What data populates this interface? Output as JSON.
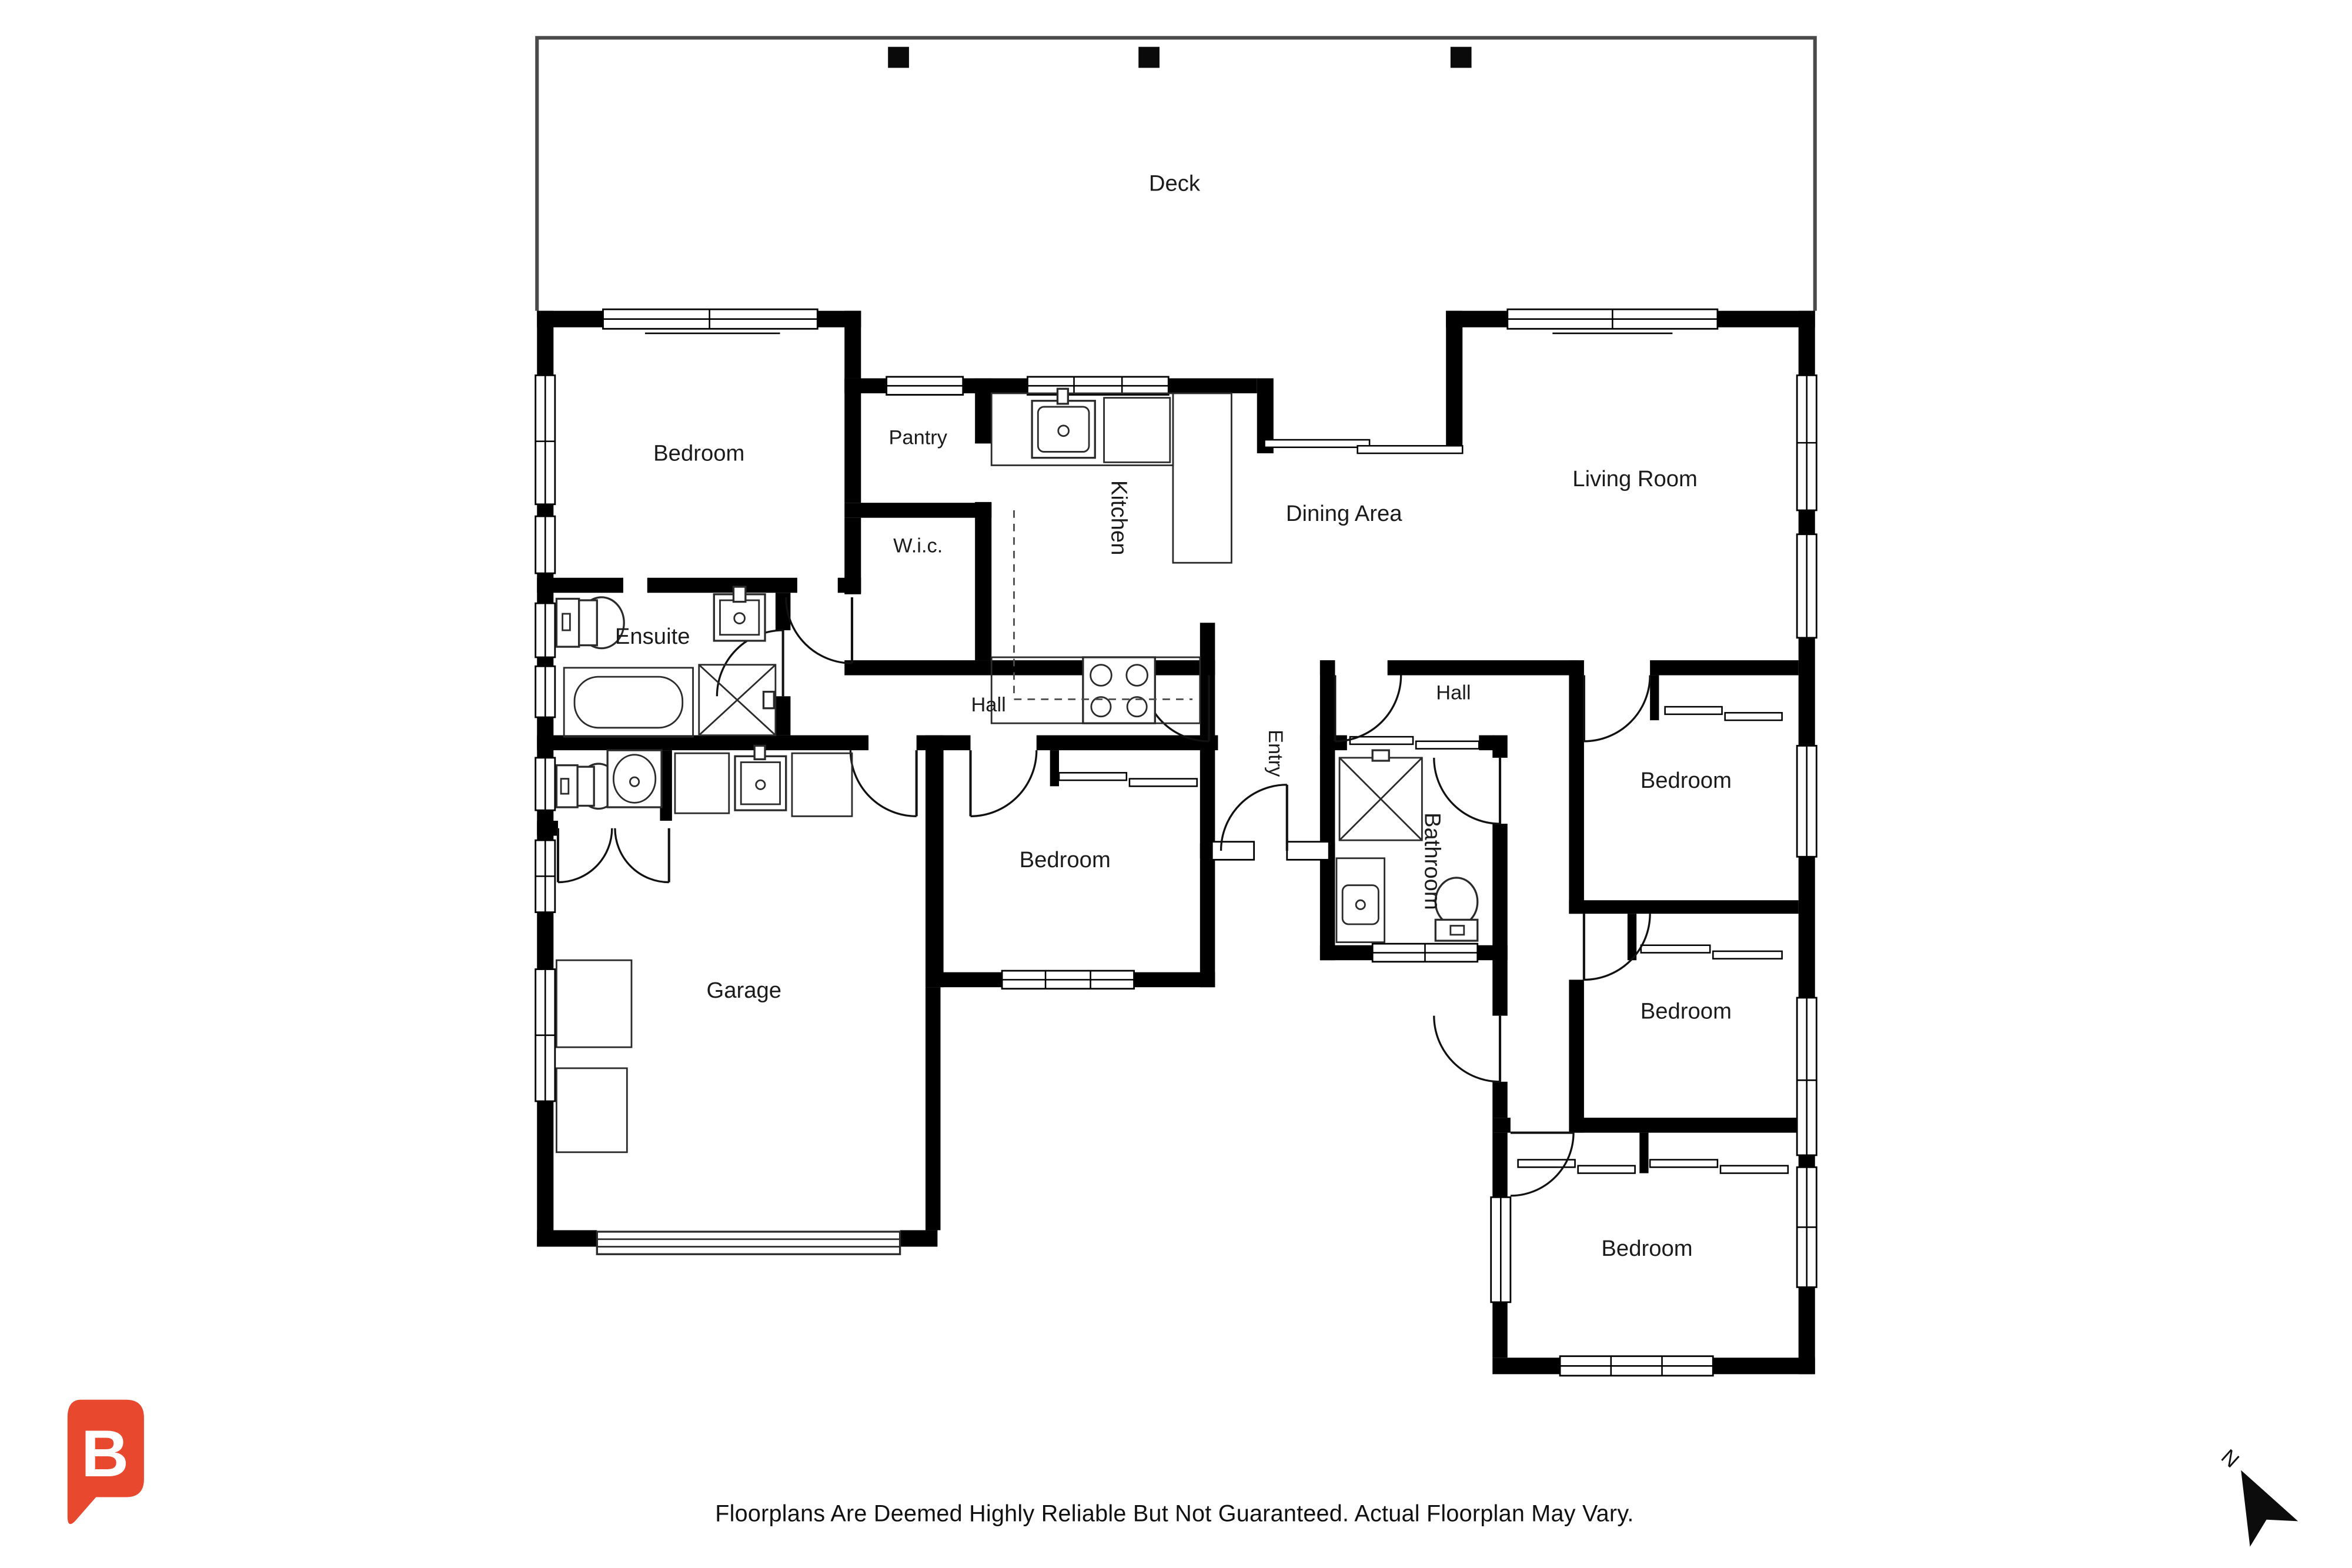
{
  "deck": {
    "label": "Deck"
  },
  "rooms": [
    {
      "id": "bedroom-master",
      "label": "Bedroom"
    },
    {
      "id": "pantry",
      "label": "Pantry"
    },
    {
      "id": "wic",
      "label": "W.i.c."
    },
    {
      "id": "kitchen",
      "label": "Kitchen"
    },
    {
      "id": "dining-area",
      "label": "Dining Area"
    },
    {
      "id": "living-room",
      "label": "Living Room"
    },
    {
      "id": "ensuite",
      "label": "Ensuite"
    },
    {
      "id": "hall-left",
      "label": "Hall"
    },
    {
      "id": "entry",
      "label": "Entry"
    },
    {
      "id": "hall-right",
      "label": "Hall"
    },
    {
      "id": "bedroom-right-top",
      "label": "Bedroom"
    },
    {
      "id": "bathroom",
      "label": "Bathroom"
    },
    {
      "id": "bedroom-center",
      "label": "Bedroom"
    },
    {
      "id": "garage",
      "label": "Garage"
    },
    {
      "id": "bedroom-right-middle",
      "label": "Bedroom"
    },
    {
      "id": "bedroom-right-bottom",
      "label": "Bedroom"
    }
  ],
  "compass": {
    "label": "N"
  },
  "logo": {
    "letter": "B",
    "color": "#e8492e"
  },
  "footer": {
    "disclaimer": "Floorplans Are Deemed Highly Reliable But Not Guaranteed. Actual Floorplan May Vary."
  }
}
